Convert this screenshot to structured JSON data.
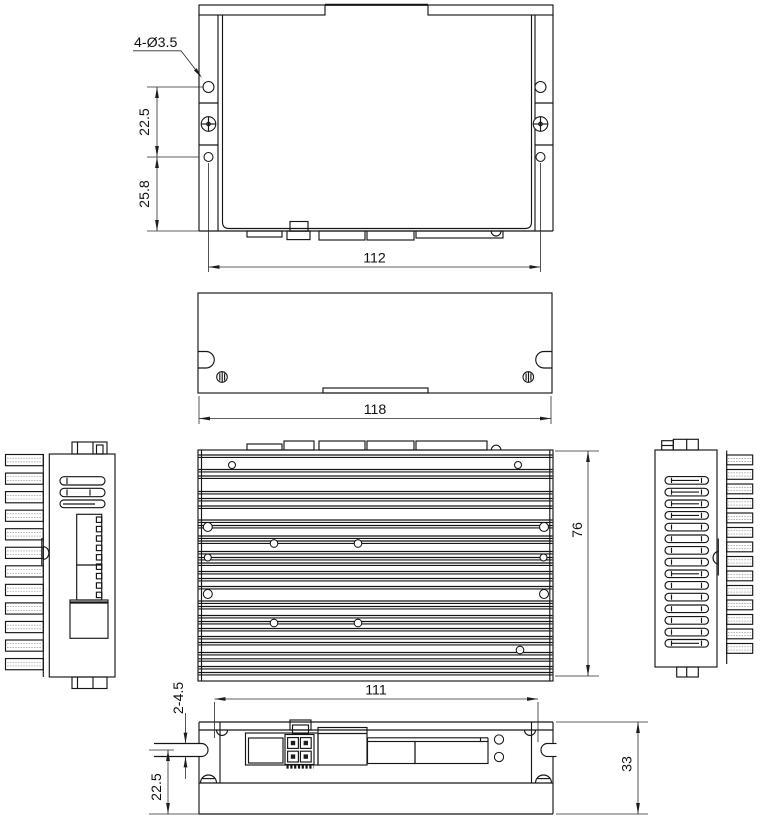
{
  "drawing": {
    "background_color": "#ffffff",
    "line_color": "#161616",
    "views": {
      "top": {
        "callout_holes": "4-Ø3.5",
        "dim_hole_spacing": "22.5",
        "dim_hole_to_edge": "25.8",
        "dim_mounting_width": "112"
      },
      "cover": {
        "dim_width": "118"
      },
      "heatsink": {
        "dim_depth": "76"
      },
      "front": {
        "dim_connector_width": "111",
        "dim_slot_callout": "2-4.5",
        "dim_slot_to_base": "22.5",
        "dim_height": "33"
      }
    }
  }
}
